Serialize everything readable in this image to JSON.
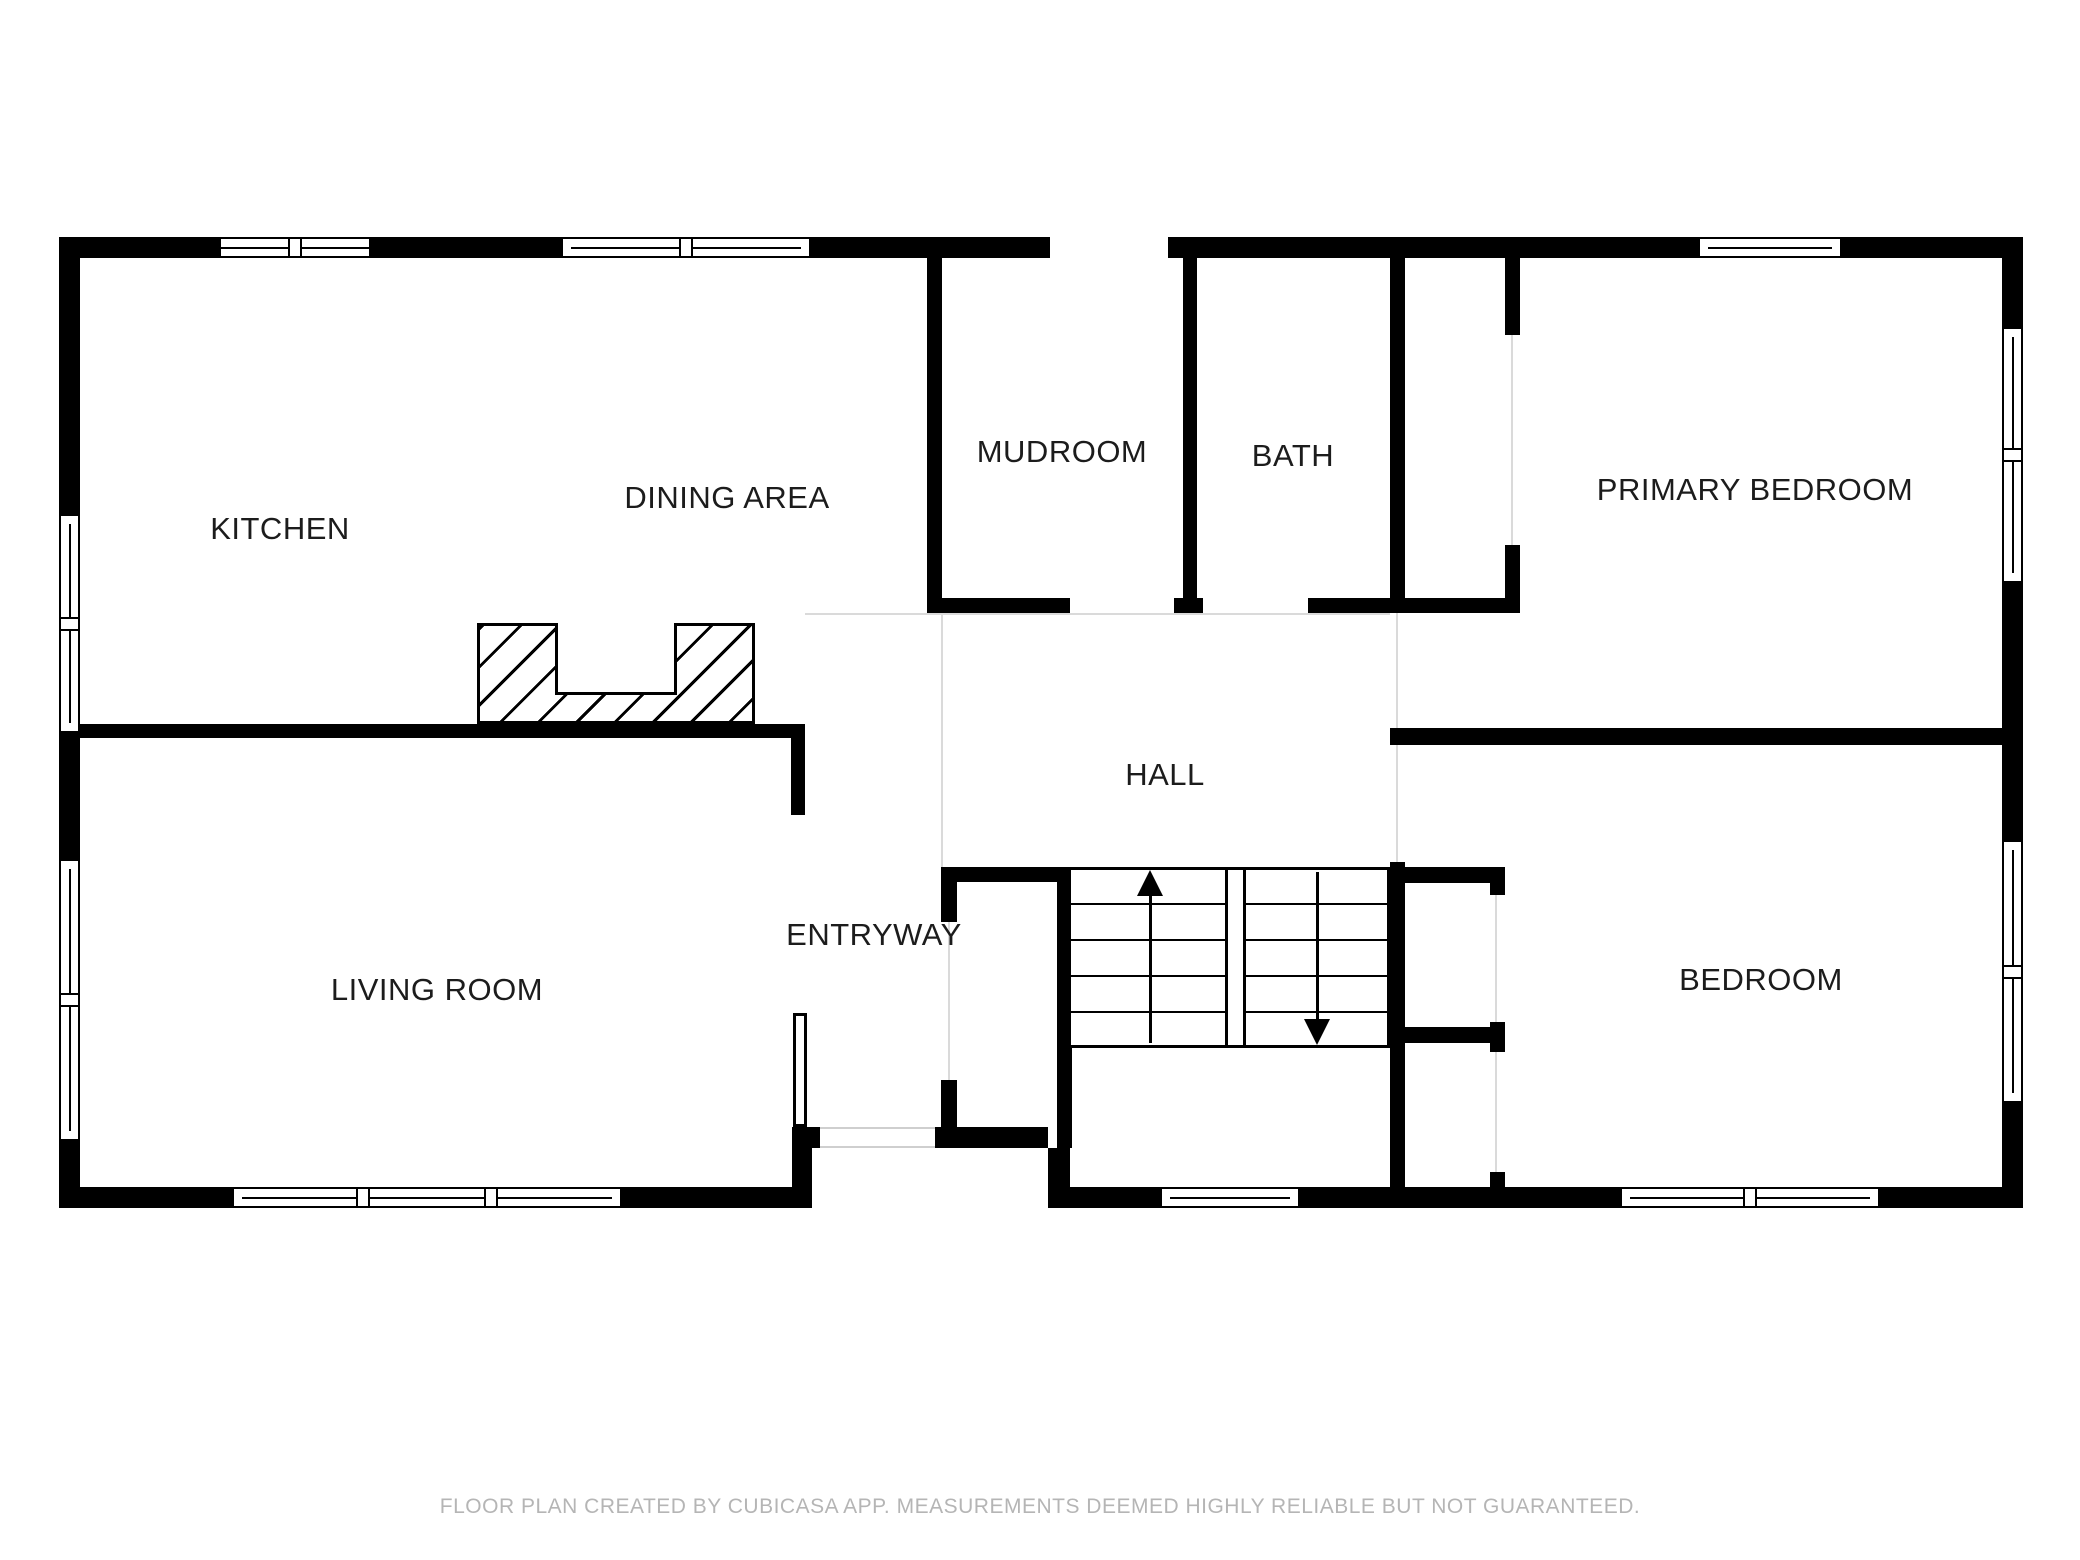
{
  "rooms": {
    "kitchen": {
      "label": "KITCHEN"
    },
    "dining": {
      "label": "DINING AREA"
    },
    "mudroom": {
      "label": "MUDROOM"
    },
    "bath": {
      "label": "BATH"
    },
    "primary": {
      "label": "PRIMARY BEDROOM"
    },
    "hall": {
      "label": "HALL"
    },
    "entryway": {
      "label": "ENTRYWAY"
    },
    "living": {
      "label": "LIVING ROOM"
    },
    "bedroom": {
      "label": "BEDROOM"
    }
  },
  "stairs": {
    "up_icon": "stairs-up-arrow",
    "down_icon": "stairs-down-arrow"
  },
  "footer": {
    "disclaimer": "FLOOR PLAN CREATED BY CUBICASA APP. MEASUREMENTS DEEMED HIGHLY RELIABLE BUT NOT GUARANTEED."
  },
  "colors": {
    "wall": "#000000",
    "background": "#ffffff",
    "label_text": "#1c1c1c",
    "disclaimer_text": "#b5b5b5",
    "hairline": "#dadada"
  }
}
